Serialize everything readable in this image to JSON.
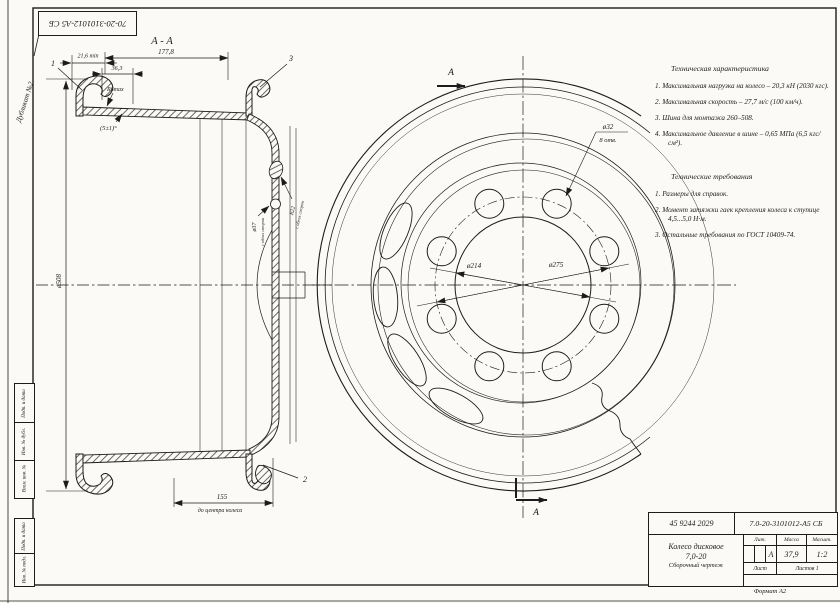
{
  "sheet": {
    "duplicate_note": "Дубликат №2",
    "top_designation": "70-20-3101012-А5 СБ",
    "format_note": "Формат А2"
  },
  "side_strip": {
    "labels": [
      "Подп. и дата",
      "Инв. № дубл.",
      "Взам. инв. №",
      "Подп. и дата",
      "Инв. № подл."
    ]
  },
  "section_view": {
    "title": "А - А",
    "dim_width": "177,8",
    "dim_min": "21,6 min",
    "dim_36": "36,3",
    "dim_r6": "R6max",
    "dim_angle": "(5±1)°",
    "dim_outer": "ø508",
    "dim_hole": "ø37",
    "dim_hole_note": "с обеих сторон",
    "dim_r22": "R22",
    "dim_r22_note": "с обеих сторон",
    "dim_offset": "155",
    "dim_offset_note": "до центра колеса",
    "callout_1": "1",
    "callout_2": "2",
    "callout_3": "3"
  },
  "front_view": {
    "section_label_top": "А",
    "section_label_bottom": "А",
    "dim_bolt_hole": "ø32",
    "dim_bolt_hole_note": "8 отв.",
    "dim_hub": "ø214",
    "dim_bolt_circle": "ø275"
  },
  "tech_characteristics": {
    "title": "Техническая характеристика",
    "items": [
      "1.  Максимальная нагрузка на колесо – 20,3 кН (2030 кгс).",
      "2.  Максимальная скорость – 27,7 м/с (100 км/ч).",
      "3.  Шина для монтажа 260–508.",
      "4.  Максимальное давление в шине – 0,65 МПа (6,5 кгс/см²)."
    ]
  },
  "tech_requirements": {
    "title": "Технические требования",
    "items": [
      "1.  Размеры для справок.",
      "2.  Момент затяжки гаек крепления колеса к ступице 4,5...5,0 Н·м.",
      "3.  Остальные требования по ГОСТ 10409-74."
    ]
  },
  "title_block": {
    "doc_number": "45 9244 2029",
    "designation": "7.0-20-3101012-А5 СБ",
    "name_line1": "Колесо дисковое",
    "name_line2": "7,0-20",
    "doc_type": "Сборочный чертеж",
    "col_lit": "Лит.",
    "col_mass": "Масса",
    "col_scale": "Масшт.",
    "lit_value": "А",
    "mass_value": "37,9",
    "scale_value": "1:2",
    "sheet_label": "Лист",
    "sheets_label": "Листов 1"
  }
}
